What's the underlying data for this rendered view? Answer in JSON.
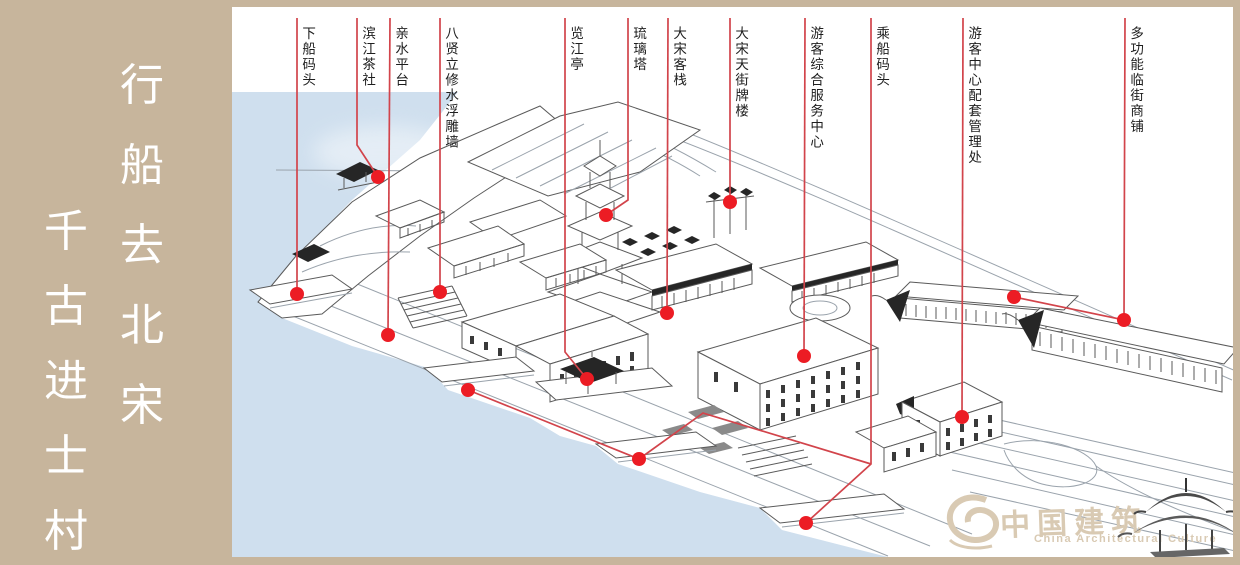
{
  "banner": {
    "columns": [
      {
        "name": "banner-column-right",
        "chars": [
          "行",
          "船",
          "去",
          "北",
          "宋"
        ]
      },
      {
        "name": "banner-column-left",
        "chars": [
          "千",
          "古",
          "进",
          "士",
          "村"
        ]
      }
    ]
  },
  "callouts": [
    {
      "label": "下船码头",
      "label_x": 300,
      "label_y": 26,
      "lines": [
        [
          [
            297,
            18
          ],
          [
            297,
            294
          ]
        ]
      ],
      "dots": [
        [
          297,
          294
        ]
      ]
    },
    {
      "label": "滨江茶社",
      "label_x": 360,
      "label_y": 26,
      "lines": [
        [
          [
            357,
            18
          ],
          [
            357,
            145
          ],
          [
            378,
            177
          ]
        ]
      ],
      "dots": [
        [
          378,
          177
        ]
      ]
    },
    {
      "label": "亲水平台",
      "label_x": 393,
      "label_y": 26,
      "lines": [
        [
          [
            390,
            18
          ],
          [
            388,
            335
          ]
        ]
      ],
      "dots": [
        [
          388,
          335
        ]
      ]
    },
    {
      "label": "八贤立修水浮雕墙",
      "label_x": 443,
      "label_y": 26,
      "lines": [
        [
          [
            440,
            18
          ],
          [
            440,
            292
          ]
        ]
      ],
      "dots": [
        [
          440,
          292
        ]
      ]
    },
    {
      "label": "览江亭",
      "label_x": 568,
      "label_y": 26,
      "lines": [
        [
          [
            565,
            18
          ],
          [
            565,
            352
          ],
          [
            587,
            379
          ]
        ]
      ],
      "dots": [
        [
          587,
          379
        ]
      ]
    },
    {
      "label": "琉璃塔",
      "label_x": 631,
      "label_y": 26,
      "lines": [
        [
          [
            628,
            18
          ],
          [
            628,
            200
          ],
          [
            606,
            215
          ]
        ]
      ],
      "dots": [
        [
          606,
          215
        ]
      ]
    },
    {
      "label": "大宋客栈",
      "label_x": 671,
      "label_y": 26,
      "lines": [
        [
          [
            668,
            18
          ],
          [
            667,
            313
          ]
        ]
      ],
      "dots": [
        [
          667,
          313
        ]
      ]
    },
    {
      "label": "大宋天街牌楼",
      "label_x": 733,
      "label_y": 26,
      "lines": [
        [
          [
            730,
            18
          ],
          [
            730,
            202
          ]
        ]
      ],
      "dots": [
        [
          730,
          202
        ]
      ]
    },
    {
      "label": "游客综合服务中心",
      "label_x": 808,
      "label_y": 26,
      "lines": [
        [
          [
            805,
            18
          ],
          [
            804,
            356
          ]
        ]
      ],
      "dots": [
        [
          804,
          356
        ]
      ]
    },
    {
      "label": "乘船码头",
      "label_x": 874,
      "label_y": 26,
      "lines": [
        [
          [
            871,
            18
          ],
          [
            871,
            464
          ],
          [
            806,
            523
          ]
        ],
        [
          [
            871,
            464
          ],
          [
            703,
            413
          ],
          [
            639,
            459
          ],
          [
            468,
            390
          ]
        ]
      ],
      "dots": [
        [
          806,
          523
        ],
        [
          639,
          459
        ],
        [
          468,
          390
        ]
      ]
    },
    {
      "label": "游客中心配套管理处",
      "label_x": 966,
      "label_y": 26,
      "lines": [
        [
          [
            963,
            18
          ],
          [
            962,
            417
          ]
        ]
      ],
      "dots": [
        [
          962,
          417
        ]
      ]
    },
    {
      "label": "多功能临街商铺",
      "label_x": 1128,
      "label_y": 26,
      "lines": [
        [
          [
            1125,
            18
          ],
          [
            1124,
            320
          ],
          [
            1014,
            297
          ]
        ]
      ],
      "dots": [
        [
          1124,
          320
        ],
        [
          1014,
          297
        ]
      ]
    }
  ],
  "watermark": {
    "cn": "中国建筑",
    "en": "China Architectural Culture"
  },
  "colors": {
    "frame": "#c7b59c",
    "water": "#cfdfee",
    "leader_line": "#d2444b",
    "dot": "#ec1c24",
    "label_text": "#1e1e1e",
    "watermark": "#d9cab3"
  }
}
